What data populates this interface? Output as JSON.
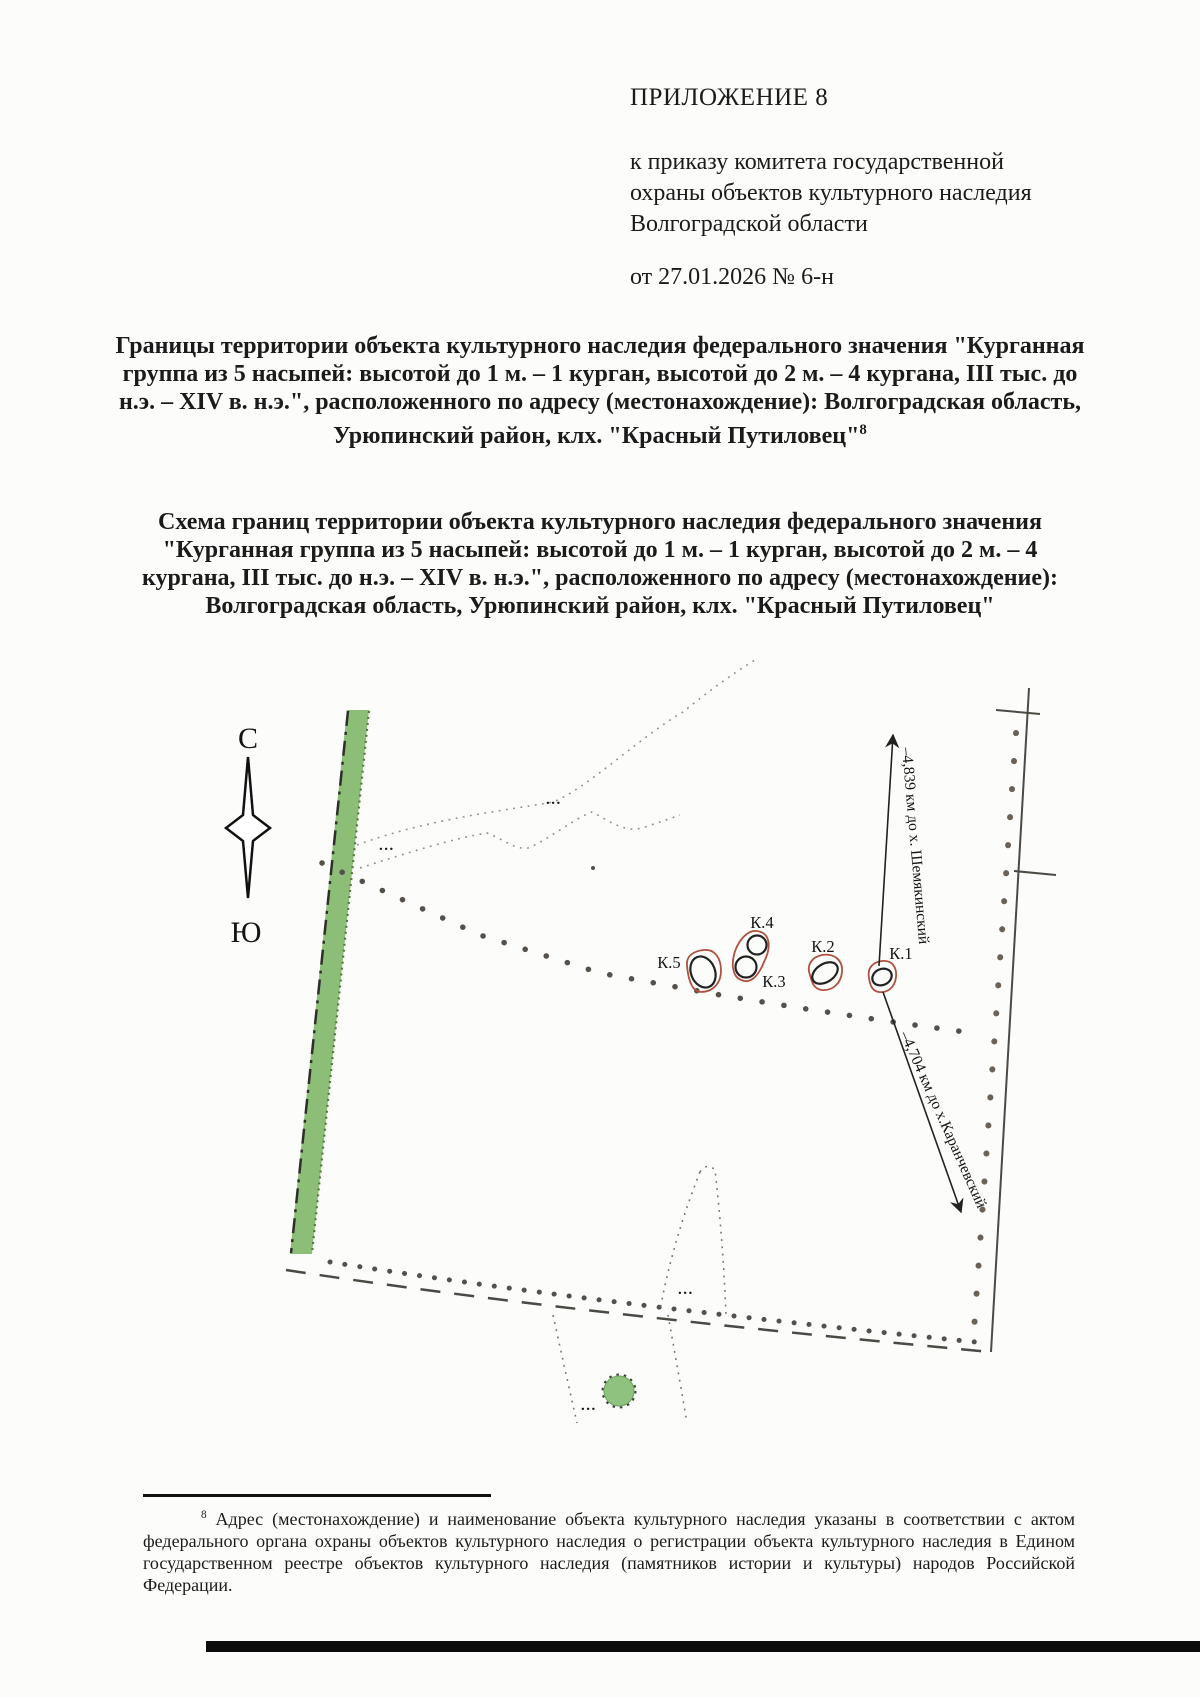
{
  "document": {
    "appendix_label": "ПРИЛОЖЕНИЕ 8",
    "issuer_block": "к приказу комитета государственной охраны объектов культурного наследия Волгоградской области",
    "order_date_line": "от 27.01.2026 № 6-н",
    "boundaries_title": "Границы территории объекта культурного наследия федерального значения \"Курганная группа из 5 насыпей: высотой до 1 м. – 1 курган, высотой до 2 м. – 4 кургана, III тыс. до н.э. – XIV в. н.э.\", расположенного по адресу (местонахождение): Волгоградская область, Урюпинский район, клх. \"Красный Путиловец\"",
    "boundaries_title_footnote_ref": "8",
    "schema_title": "Схема границ территории объекта культурного наследия федерального значения \"Курганная группа из 5 насыпей: высотой до 1 м. – 1 курган, высотой до 2 м. – 4 кургана, III тыс. до н.э. – XIV в. н.э.\", расположенного по адресу (местонахождение): Волгоградская область, Урюпинский район, клх. \"Красный Путиловец\"",
    "footnote": {
      "ref": "8",
      "text": "Адрес (местонахождение) и наименование объекта культурного наследия указаны в соответствии с актом федерального органа охраны объектов культурного наследия о регистрации объекта культурного наследия в Едином государственном реестре объектов культурного наследия (памятников истории и культуры) народов Российской Федерации."
    }
  },
  "map": {
    "compass": {
      "north_label": "С",
      "south_label": "Ю"
    },
    "kurgans": [
      {
        "id": "K.5",
        "label": "К.5"
      },
      {
        "id": "K.4",
        "label": "К.4"
      },
      {
        "id": "K.3",
        "label": "К.3"
      },
      {
        "id": "K.2",
        "label": "К.2"
      },
      {
        "id": "K.1",
        "label": "К.1"
      }
    ],
    "distance_labels": {
      "to_shemyakinsky": "–4,839 км до х. Шемякинский",
      "to_karanchevsky": "–4,704 км до х.Каранчевский"
    },
    "symbol_marks": [
      "...",
      "...",
      "...",
      "..."
    ],
    "colors": {
      "forest_belt_green": "#8cbe78",
      "tree_grove_green": "#8fc27e",
      "kurgan_outline_red": "#ad5240",
      "boundary_dot_gray": "#55514a",
      "line_black": "#3c3c38"
    }
  }
}
